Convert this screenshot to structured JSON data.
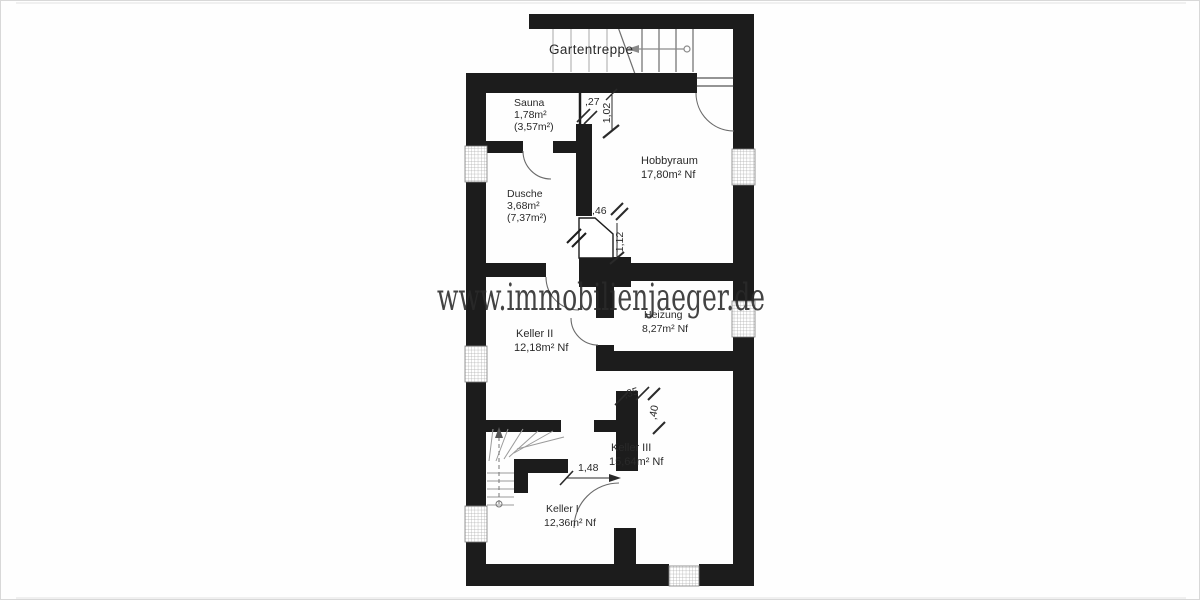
{
  "watermark": {
    "text": "www.immobilienjaeger.de"
  },
  "stairs": {
    "garden_label": "Gartentreppe"
  },
  "rooms": {
    "sauna": {
      "name": "Sauna",
      "area": "1,78m²",
      "area2": "(3,57m²)"
    },
    "dusche": {
      "name": "Dusche",
      "area": "3,68m²",
      "area2": "(7,37m²)"
    },
    "hobbyraum": {
      "name": "Hobbyraum",
      "area": "17,80m² Nf"
    },
    "heizung": {
      "name": "Heizung",
      "area": "8,27m² Nf"
    },
    "keller1": {
      "name": "Keller I",
      "area": "12,36m² Nf"
    },
    "keller2": {
      "name": "Keller II",
      "area": "12,18m² Nf"
    },
    "keller3": {
      "name": "Keller III",
      "area": "15,64m² Nf"
    }
  },
  "dims": {
    "d_027": ",27",
    "d_102": "1,02",
    "d_046": ",46",
    "d_112": "1,12",
    "d_035": ",35",
    "d_040": ",40",
    "d_148": "1,48"
  },
  "colors": {
    "wall": "#1c1c1c",
    "watermark": "#1c1c1c",
    "tread_gray": "#9a9a9a"
  }
}
